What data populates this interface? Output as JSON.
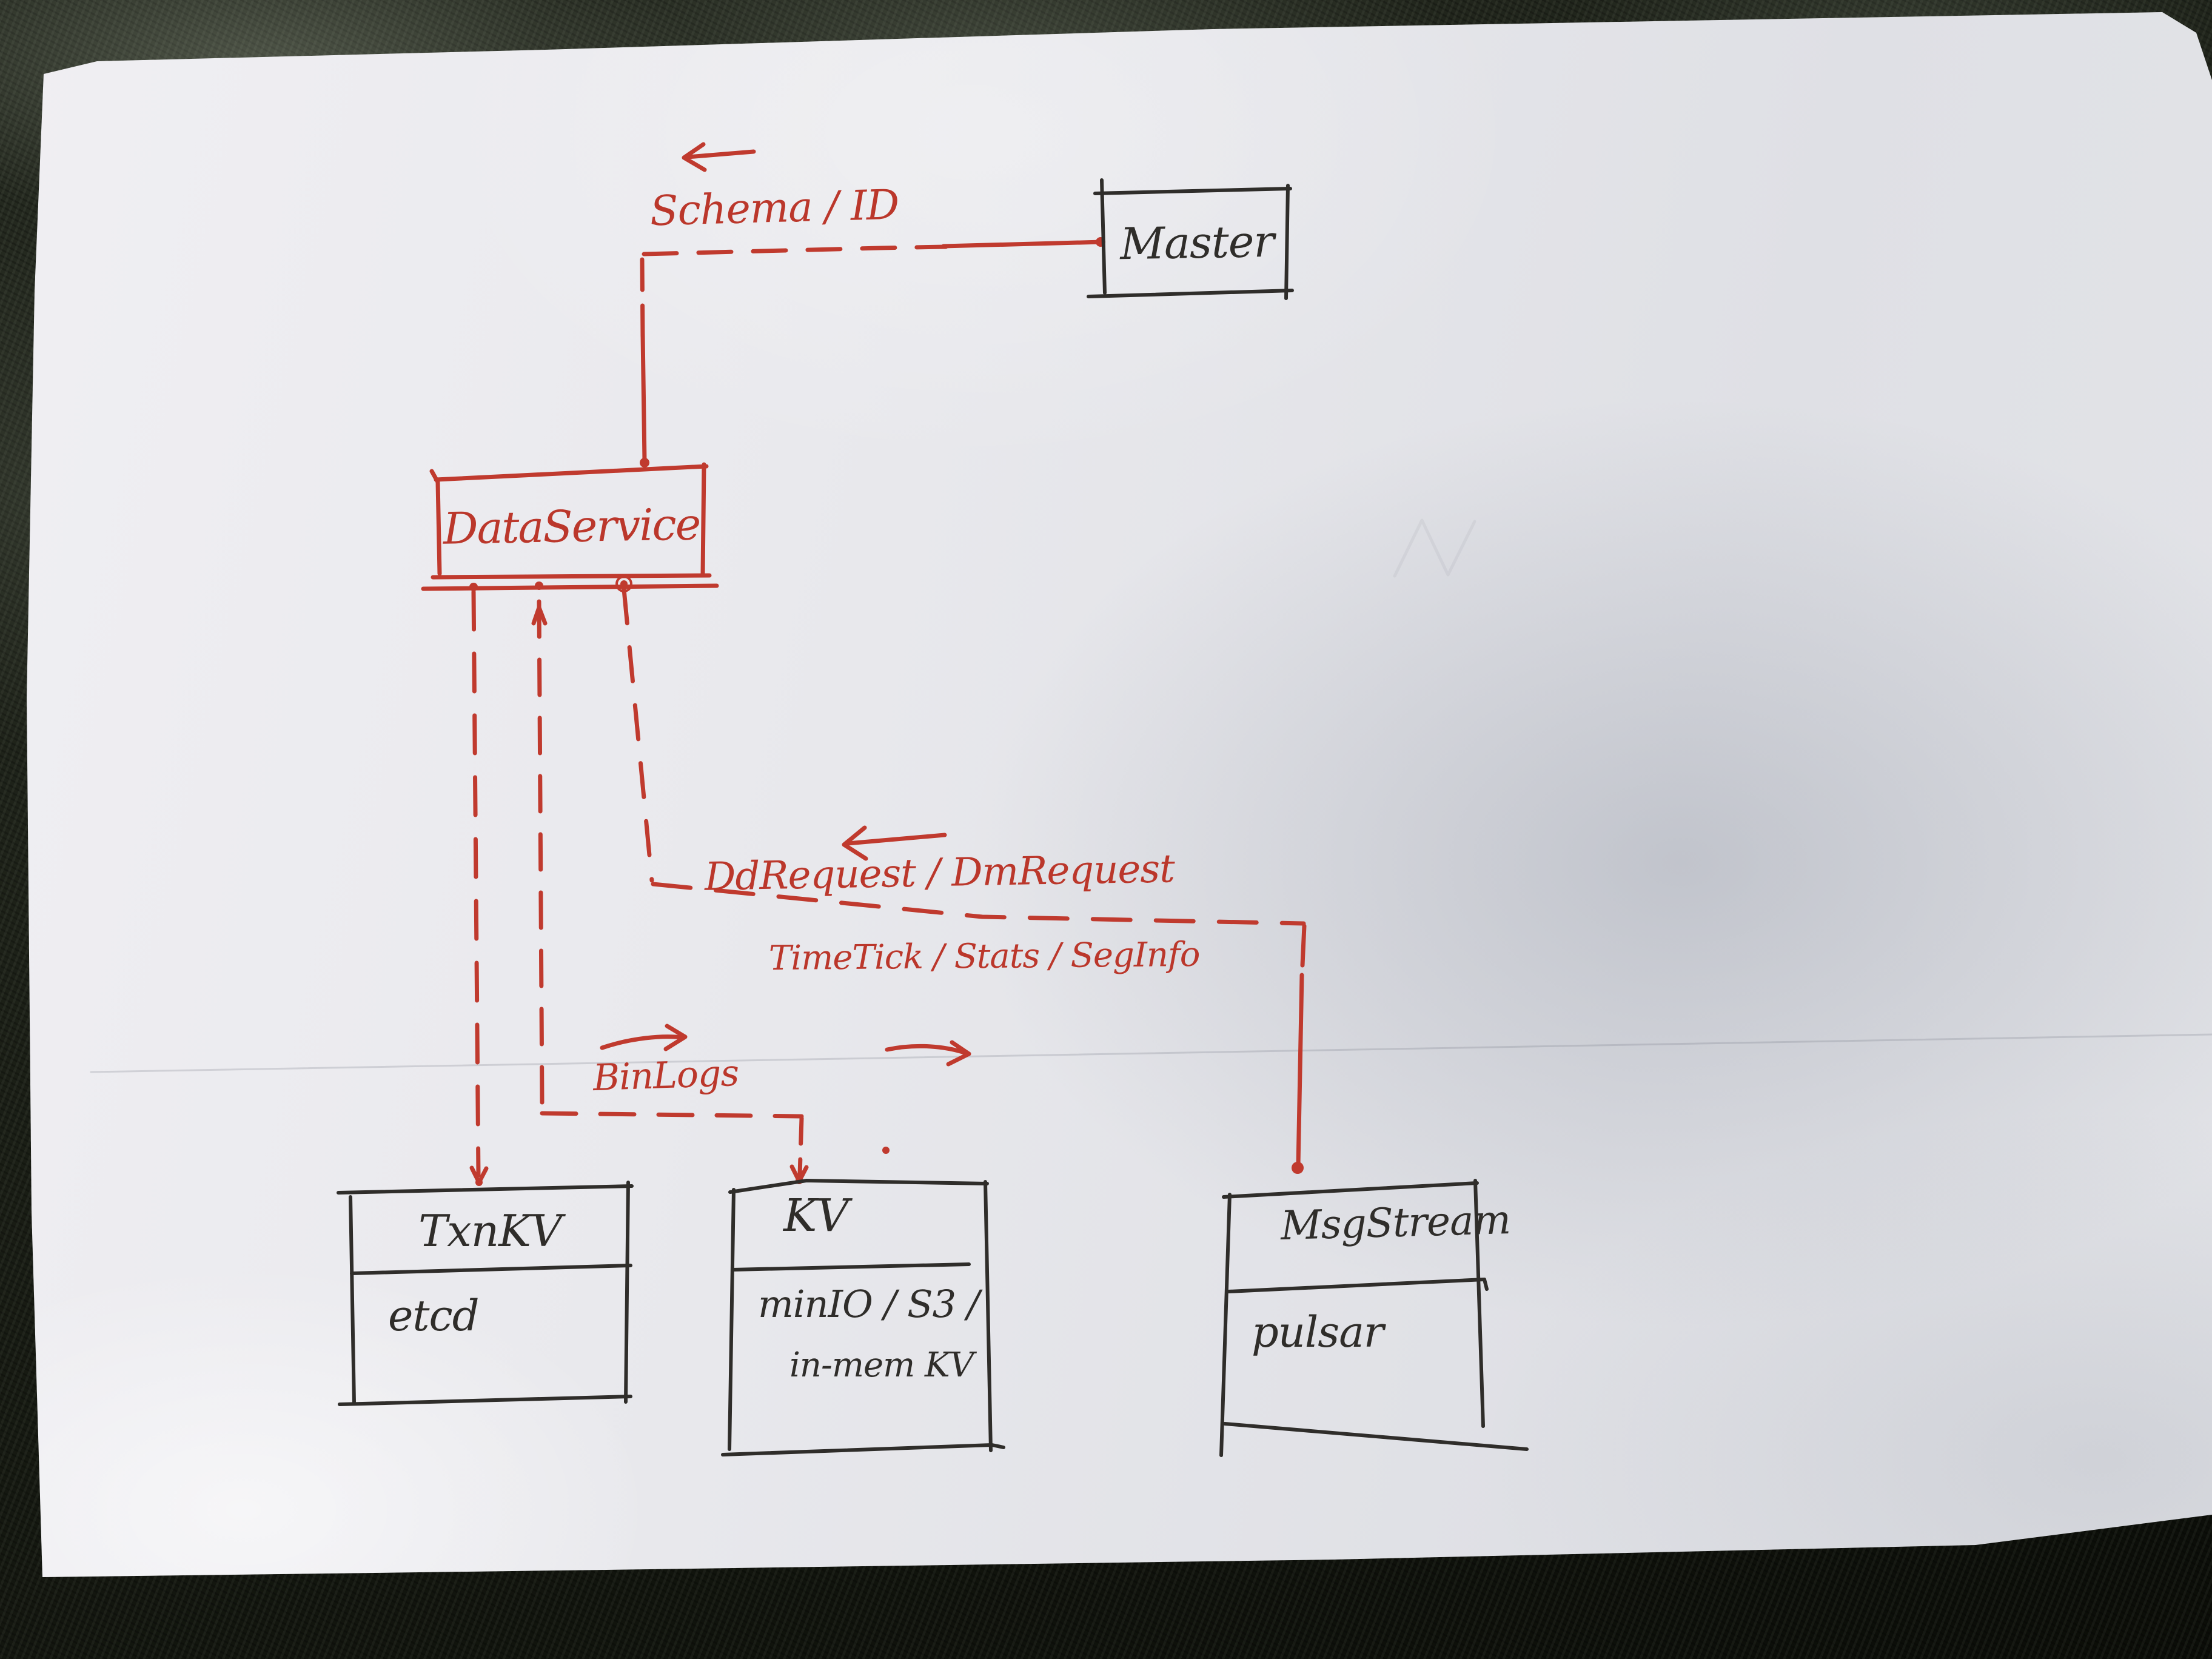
{
  "ink": {
    "red": "#bb372b",
    "black": "#2f2d2a"
  },
  "diagram": {
    "nodes": {
      "master": {
        "title": "Master"
      },
      "dataservice": {
        "title": "DataService"
      },
      "txnkv": {
        "title": "TxnKV",
        "impl": "etcd"
      },
      "kv": {
        "title": "KV",
        "impl_line1": "minIO / S3 /",
        "impl_line2": "in-mem KV"
      },
      "msgstream": {
        "title": "MsgStream",
        "impl": "pulsar"
      }
    },
    "edge_labels": {
      "schema": "Schema / ID",
      "requests": "DdRequest / DmRequest",
      "timetick": "TimeTick / Stats / SegInfo",
      "binlogs": "BinLogs"
    }
  }
}
